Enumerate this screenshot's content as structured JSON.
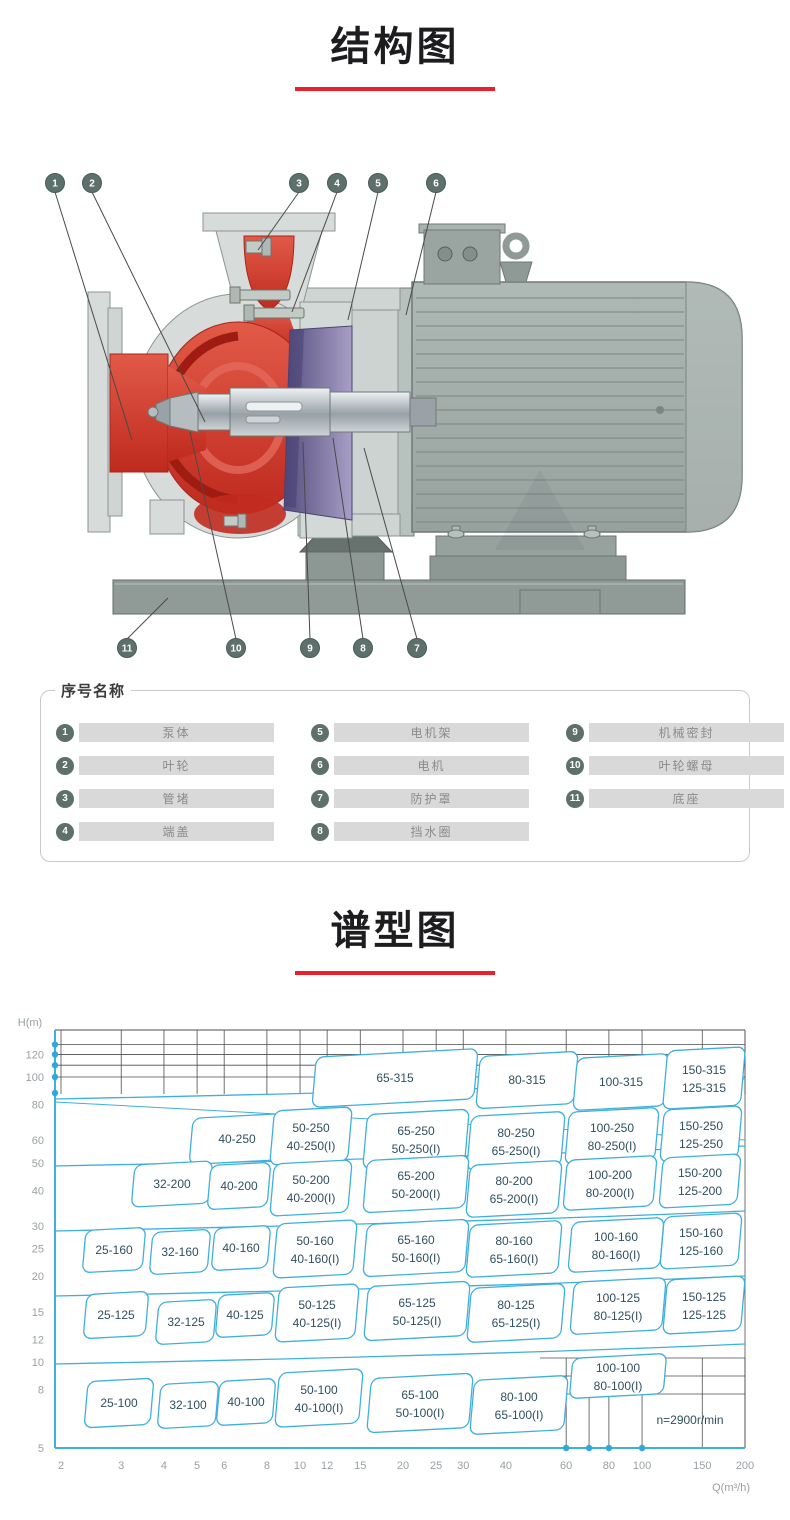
{
  "titles": {
    "structure": "结构图",
    "spectrum": "谱型图"
  },
  "accent_red": "#e8212c",
  "structure_diagram": {
    "callouts_top": [
      "1",
      "2",
      "3",
      "4",
      "5",
      "6"
    ],
    "callouts_bottom": [
      "11",
      "10",
      "9",
      "8",
      "7"
    ],
    "colors": {
      "pump_red": "#c92b1f",
      "casing_gray": "#d7dbd9",
      "motor_gray": "#a6b0ac",
      "bracket_purple": "#564e80",
      "base_gray": "#909a96",
      "callout_circle": "#5d706b"
    }
  },
  "parts_list": {
    "box_title": "序号名称",
    "items": [
      {
        "num": "1",
        "label": "泵体"
      },
      {
        "num": "2",
        "label": "叶轮"
      },
      {
        "num": "3",
        "label": "管堵"
      },
      {
        "num": "4",
        "label": "端盖"
      },
      {
        "num": "5",
        "label": "电机架"
      },
      {
        "num": "6",
        "label": "电机"
      },
      {
        "num": "7",
        "label": "防护罩"
      },
      {
        "num": "8",
        "label": "挡水圈"
      },
      {
        "num": "9",
        "label": "机械密封"
      },
      {
        "num": "10",
        "label": "叶轮螺母"
      },
      {
        "num": "11",
        "label": "底座"
      }
    ]
  },
  "chart_data": {
    "type": "region-map",
    "title": "谱型图",
    "xlabel": "Q(m³/h)",
    "ylabel": "H(m)",
    "x_scale": "log",
    "y_scale": "log",
    "x_range": [
      2,
      200
    ],
    "y_range": [
      5,
      130
    ],
    "x_ticks": [
      2,
      3,
      4,
      5,
      6,
      8,
      10,
      12,
      15,
      20,
      25,
      30,
      40,
      60,
      80,
      100,
      150,
      200
    ],
    "y_ticks": [
      120,
      100,
      80,
      60,
      50,
      40,
      30,
      25,
      20,
      15,
      12,
      10,
      8,
      5
    ],
    "annotation": "n=2900r/min",
    "line_color": "#3fafdd",
    "grid_color": "#4d4d4d",
    "label_color": "#2f4f5f",
    "tick_color": "#98a0a3",
    "regions": [
      {
        "labels": [
          "65-315"
        ],
        "box": [
          395,
          68,
          162,
          50
        ]
      },
      {
        "labels": [
          "80-315"
        ],
        "box": [
          527,
          70,
          98,
          52
        ]
      },
      {
        "labels": [
          "100-315"
        ],
        "box": [
          621,
          72,
          92,
          52
        ]
      },
      {
        "labels": [
          "150-315",
          "125-315"
        ],
        "box": [
          704,
          68,
          78,
          58
        ]
      },
      {
        "labels": [
          "40-250"
        ],
        "box": [
          237,
          129,
          92,
          46
        ]
      },
      {
        "labels": [
          "50-250",
          "40-250(I)"
        ],
        "box": [
          311,
          126,
          78,
          54
        ]
      },
      {
        "labels": [
          "65-250",
          "50-250(I)"
        ],
        "box": [
          416,
          129,
          102,
          54
        ]
      },
      {
        "labels": [
          "80-250",
          "65-250(I)"
        ],
        "box": [
          516,
          131,
          94,
          54
        ]
      },
      {
        "labels": [
          "100-250",
          "80-250(I)"
        ],
        "box": [
          612,
          126,
          90,
          52
        ]
      },
      {
        "labels": [
          "150-250",
          "125-250"
        ],
        "box": [
          701,
          124,
          78,
          52
        ]
      },
      {
        "labels": [
          "32-200"
        ],
        "box": [
          172,
          174,
          78,
          42
        ]
      },
      {
        "labels": [
          "40-200"
        ],
        "box": [
          239,
          176,
          60,
          44
        ]
      },
      {
        "labels": [
          "50-200",
          "40-200(I)"
        ],
        "box": [
          311,
          178,
          78,
          52
        ]
      },
      {
        "labels": [
          "65-200",
          "50-200(I)"
        ],
        "box": [
          416,
          174,
          102,
          52
        ]
      },
      {
        "labels": [
          "80-200",
          "65-200(I)"
        ],
        "box": [
          514,
          179,
          92,
          52
        ]
      },
      {
        "labels": [
          "100-200",
          "80-200(I)"
        ],
        "box": [
          610,
          173,
          90,
          50
        ]
      },
      {
        "labels": [
          "150-200",
          "125-200"
        ],
        "box": [
          700,
          171,
          78,
          50
        ]
      },
      {
        "labels": [
          "25-160"
        ],
        "box": [
          114,
          240,
          60,
          42
        ]
      },
      {
        "labels": [
          "32-160"
        ],
        "box": [
          180,
          242,
          58,
          42
        ]
      },
      {
        "labels": [
          "40-160"
        ],
        "box": [
          241,
          238,
          56,
          42
        ]
      },
      {
        "labels": [
          "50-160",
          "40-160(I)"
        ],
        "box": [
          315,
          239,
          80,
          54
        ]
      },
      {
        "labels": [
          "65-160",
          "50-160(I)"
        ],
        "box": [
          416,
          238,
          102,
          52
        ]
      },
      {
        "labels": [
          "80-160",
          "65-160(I)"
        ],
        "box": [
          514,
          239,
          92,
          52
        ]
      },
      {
        "labels": [
          "100-160",
          "80-160(I)"
        ],
        "box": [
          616,
          235,
          92,
          50
        ]
      },
      {
        "labels": [
          "150-160",
          "125-160"
        ],
        "box": [
          701,
          231,
          78,
          52
        ]
      },
      {
        "labels": [
          "25-125"
        ],
        "box": [
          116,
          305,
          62,
          44
        ]
      },
      {
        "labels": [
          "32-125"
        ],
        "box": [
          186,
          312,
          58,
          42
        ]
      },
      {
        "labels": [
          "40-125"
        ],
        "box": [
          245,
          305,
          56,
          42
        ]
      },
      {
        "labels": [
          "50-125",
          "40-125(I)"
        ],
        "box": [
          317,
          303,
          80,
          54
        ]
      },
      {
        "labels": [
          "65-125",
          "50-125(I)"
        ],
        "box": [
          417,
          301,
          102,
          54
        ]
      },
      {
        "labels": [
          "80-125",
          "65-125(I)"
        ],
        "box": [
          516,
          303,
          94,
          54
        ]
      },
      {
        "labels": [
          "100-125",
          "80-125(I)"
        ],
        "box": [
          618,
          296,
          92,
          52
        ]
      },
      {
        "labels": [
          "150-125",
          "125-125"
        ],
        "box": [
          704,
          295,
          78,
          54
        ]
      },
      {
        "labels": [
          "25-100"
        ],
        "box": [
          119,
          393,
          66,
          46
        ]
      },
      {
        "labels": [
          "32-100"
        ],
        "box": [
          188,
          395,
          58,
          44
        ]
      },
      {
        "labels": [
          "40-100"
        ],
        "box": [
          246,
          392,
          56,
          44
        ]
      },
      {
        "labels": [
          "50-100",
          "40-100(I)"
        ],
        "box": [
          319,
          388,
          84,
          54
        ]
      },
      {
        "labels": [
          "65-100",
          "50-100(I)"
        ],
        "box": [
          420,
          393,
          102,
          54
        ]
      },
      {
        "labels": [
          "80-100",
          "65-100(I)"
        ],
        "box": [
          519,
          395,
          94,
          54
        ]
      },
      {
        "labels": [
          "100-100",
          "80-100(I)"
        ],
        "box": [
          618,
          366,
          94,
          40
        ]
      }
    ]
  }
}
